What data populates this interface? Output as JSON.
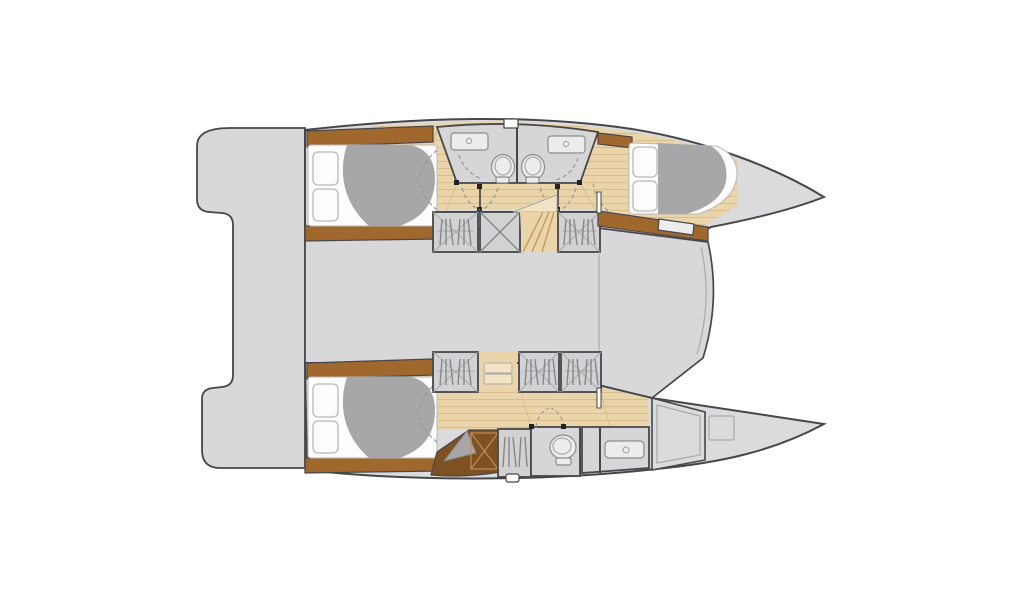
{
  "canvas": {
    "width": 1024,
    "height": 600
  },
  "diagram": {
    "kind": "catamaran-interior-floor-plan-top-view",
    "features": [
      "stern-crossbeam",
      "bridge-deck",
      "port-hull",
      "starboard-hull",
      "port-aft-cabin-double-berth",
      "port-forward-cabin-double-berth",
      "twin-central-bathrooms-with-sinks-and-toilets",
      "starboard-aft-cabin-double-berth",
      "starboard-toilet-compartment",
      "starboard-sink-counter",
      "wardrobes-with-hanging-clothes",
      "companionway-stairs",
      "bow-storage-compartment-with-hatch",
      "mast-beam-line",
      "door-swing-arcs"
    ]
  },
  "colors": {
    "background": "#ffffff",
    "white": "#ffffff",
    "outline": "#47474a",
    "hull_fill": "#dbdbdd",
    "deck_fill": "#d8d8da",
    "floor_fill": "#ead4aa",
    "floor_plank_line": "#d9bd8f",
    "floor_light": "#f2e3c4",
    "stair_line": "#c09055",
    "trim_brown": "#a1682e",
    "stairs_dark_brown": "#7d5122",
    "duvet_gray": "#a7a7a9",
    "mattress_white": "#fdfdfd",
    "pillow_stroke": "#b9b9bb",
    "bath_fill": "#d6d6d8",
    "fixture_fill": "#ececee",
    "fixture_stroke": "#8b8b8d",
    "wardrobe_fill": "#d2d2d4",
    "glyph_line": "#87878a",
    "dash_line": "#98989a",
    "thin_line": "#a9a9ab",
    "dot_black": "#222224"
  }
}
